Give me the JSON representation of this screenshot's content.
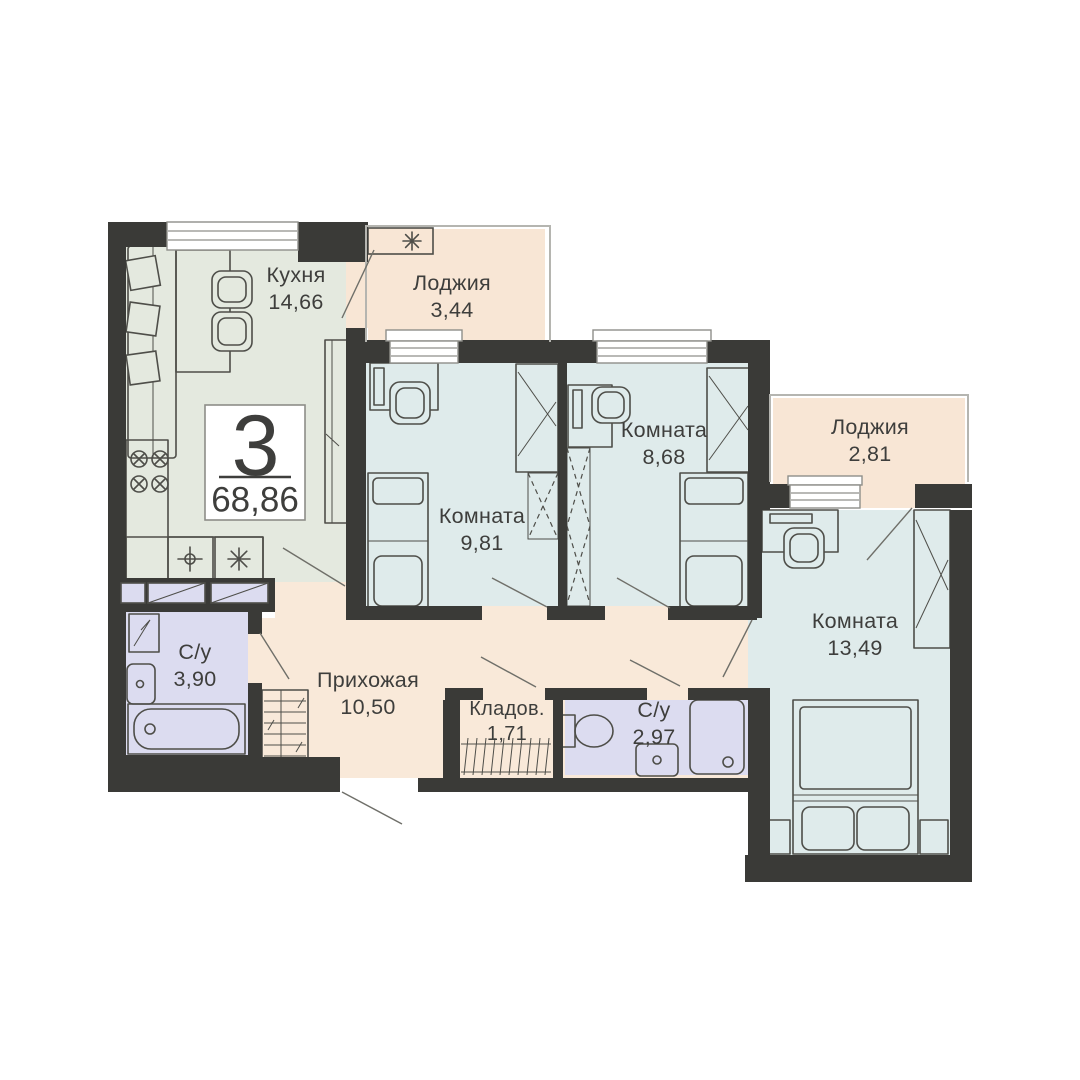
{
  "plan": {
    "apartment": {
      "rooms_count": "3",
      "total_area": "68,86"
    },
    "rooms": [
      {
        "name": "Кухня",
        "area": "14,66"
      },
      {
        "name": "Лоджия",
        "area": "3,44"
      },
      {
        "name": "Комната",
        "area": "9,81"
      },
      {
        "name": "Комната",
        "area": "8,68"
      },
      {
        "name": "Лоджия",
        "area": "2,81"
      },
      {
        "name": "Комната",
        "area": "13,49"
      },
      {
        "name": "С/у",
        "area": "3,90"
      },
      {
        "name": "Прихожая",
        "area": "10,50"
      },
      {
        "name": "Кладов.",
        "area": "1,71"
      },
      {
        "name": "С/у",
        "area": "2,97"
      }
    ],
    "colors": {
      "background": "#ffffff",
      "wall": "#3a3a37",
      "kitchen": "#e4e9df",
      "room": "#dfebeb",
      "loggia": "#f8e6d5",
      "hallway": "#f9e9d9",
      "bathroom": "#dcdcf0",
      "furniture": "#4e4e49",
      "door_line": "#6f6f69",
      "window_border": "#8f8f8a",
      "glazing": "#b5b5b0",
      "box_border": "#8d8d88",
      "text": "#3e3e3c",
      "nightstand": "#dfe6e1"
    }
  }
}
